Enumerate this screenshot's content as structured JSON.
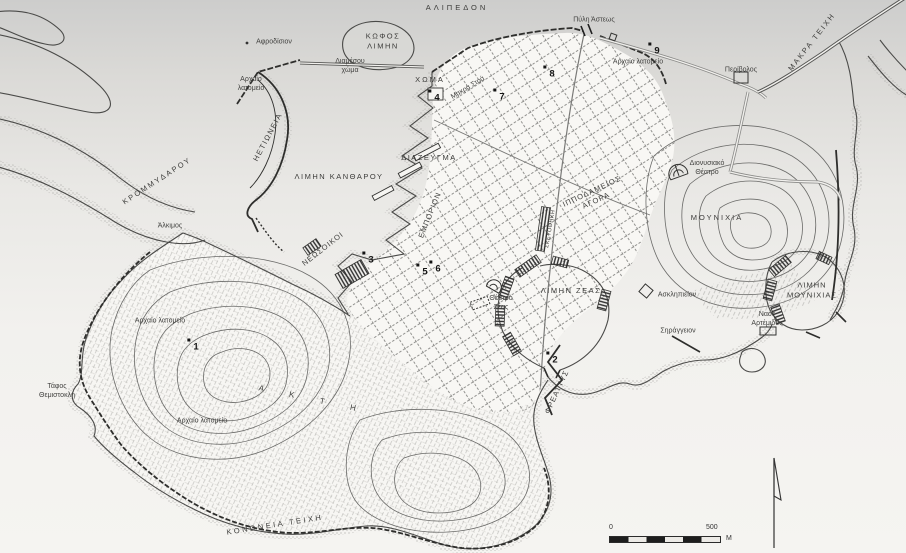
{
  "map": {
    "title": "Χάρτης αρχαίου Πειραιά",
    "scale_bar": {
      "zero": "0",
      "five_hundred": "500",
      "unit": "M"
    },
    "colors": {
      "ink": "#3d3d3b",
      "paper": "#f3f2ef",
      "paper_top": "#cdcdcc",
      "shade": "#b9b8b5",
      "wall": "#2e2e2c"
    },
    "labels": [
      {
        "id": "alipedon",
        "text": "ΑΛΙΠΕΔΟΝ",
        "x": 457,
        "y": 8,
        "cls": "region",
        "ls": 3
      },
      {
        "id": "kofos-limen",
        "lines": [
          "ΚΩΦΟΣ",
          "ΛΙΜΗΝ"
        ],
        "x": 383,
        "y": 41,
        "cls": "region",
        "ls": 1.5
      },
      {
        "id": "pyli-asteos",
        "text": "Πύλη Άστεως",
        "x": 594,
        "y": 20,
        "cls": "place"
      },
      {
        "id": "afrodision",
        "text": "Αφροδίσιον",
        "x": 274,
        "y": 42,
        "cls": "place"
      },
      {
        "id": "archaio-latomeio-west",
        "lines": [
          "Αρχαίο",
          "λατομείο"
        ],
        "x": 251,
        "y": 84,
        "cls": "place"
      },
      {
        "id": "diamesou-choma",
        "lines": [
          "Διαμέσου",
          "χώμα"
        ],
        "x": 350,
        "y": 66,
        "cls": "place"
      },
      {
        "id": "choma",
        "text": "ΧΩΜΑ",
        "x": 430,
        "y": 80,
        "cls": "region",
        "ls": 2
      },
      {
        "id": "makra-stoa",
        "text": "Μακρά Στοά",
        "x": 468,
        "y": 88,
        "rot": -31,
        "cls": "place"
      },
      {
        "id": "archaio-latomeio-ne",
        "text": "Αρχαίο λατομείο",
        "x": 638,
        "y": 62,
        "cls": "place"
      },
      {
        "id": "perivolos",
        "text": "Περίβολος",
        "x": 741,
        "y": 70,
        "cls": "place"
      },
      {
        "id": "makra-teichi",
        "text": "ΜΑΚΡΑ ΤΕΙΧΗ",
        "x": 812,
        "y": 42,
        "rot": -52,
        "cls": "region",
        "ls": 2
      },
      {
        "id": "hetioneia",
        "text": "ΗΕΤΙΩΝΕΙΑ",
        "x": 268,
        "y": 137,
        "rot": -62,
        "cls": "region",
        "ls": 1.5
      },
      {
        "id": "krommydarou",
        "text": "ΚΡΟΜΜΥΔΑΡΟΥ",
        "x": 157,
        "y": 181,
        "rot": -33,
        "cls": "region",
        "ls": 2
      },
      {
        "id": "limen-kantharou",
        "text": "ΛΙΜΗΝ ΚΑΝΘΑΡΟΥ",
        "x": 339,
        "y": 177,
        "cls": "region",
        "ls": 1.5
      },
      {
        "id": "diazeugma",
        "text": "ΔΙΑΖΕΥΓΜΑ",
        "x": 429,
        "y": 158,
        "cls": "region",
        "ls": 1.5
      },
      {
        "id": "emporion",
        "text": "ΕΜΠΟΡΙΟΝ",
        "x": 430,
        "y": 215,
        "rot": -68,
        "cls": "region",
        "ls": 1
      },
      {
        "id": "dionysiako-theatro",
        "lines": [
          "Διονυσιακό",
          "Θέατρο"
        ],
        "x": 707,
        "y": 168,
        "cls": "place"
      },
      {
        "id": "hippodameios-agora",
        "lines": [
          "ΙΠΠΟΔΑΜΕΙΟΣ",
          "ΑΓΟΡΑ"
        ],
        "x": 594,
        "y": 196,
        "rot": -25,
        "cls": "region",
        "ls": 1
      },
      {
        "id": "mounichia",
        "text": "ΜΟΥΝΙΧΙΑ",
        "x": 717,
        "y": 218,
        "cls": "region",
        "ls": 2
      },
      {
        "id": "alkimos",
        "text": "Άλκιμος",
        "x": 170,
        "y": 226,
        "cls": "place"
      },
      {
        "id": "neosoikoi",
        "text": "ΝΕΩΣΟΙΚΟΙ",
        "x": 323,
        "y": 249,
        "rot": -38,
        "cls": "region",
        "ls": 1
      },
      {
        "id": "skeyothiki",
        "text": "ΣΚΕΥΟΘΗΚΗ",
        "x": 551,
        "y": 229,
        "rot": -80,
        "cls": "region",
        "fs": 5.5,
        "ls": 0.5
      },
      {
        "id": "limen-zeas",
        "text": "ΛΙΜΗΝ ΖΕΑΣ",
        "x": 571,
        "y": 291,
        "cls": "region",
        "ls": 1.5
      },
      {
        "id": "theatro-zeas",
        "lines": [
          "Θέατρο",
          "Ζέας"
        ],
        "x": 501,
        "y": 303,
        "cls": "place"
      },
      {
        "id": "asklipieion",
        "text": "Ασκληπιείον",
        "x": 677,
        "y": 295,
        "cls": "place"
      },
      {
        "id": "limen-mounichias",
        "lines": [
          "ΛΙΜΗΝ",
          "ΜΟΥΝΙΧΙΑΣ"
        ],
        "x": 812,
        "y": 290,
        "cls": "region",
        "ls": 1
      },
      {
        "id": "naos-artemidos",
        "lines": [
          "Ναός",
          "Αρτέμιδος"
        ],
        "x": 767,
        "y": 319,
        "cls": "place"
      },
      {
        "id": "syrangeion",
        "text": "Σηράγγειον",
        "x": 678,
        "y": 331,
        "cls": "place"
      },
      {
        "id": "archaio-latomeio-akti-n",
        "text": "Αρχαίο λατομείο",
        "x": 160,
        "y": 321,
        "cls": "place"
      },
      {
        "id": "tafos-themistokli",
        "lines": [
          "Τάφος",
          "Θεμιστοκλή"
        ],
        "x": 57,
        "y": 391,
        "cls": "place"
      },
      {
        "id": "akti",
        "text": "Α Κ Τ Η",
        "x": 313,
        "y": 400,
        "rot": 12,
        "cls": "region",
        "ls": 12,
        "fs": 8
      },
      {
        "id": "archaio-latomeio-akti-s",
        "text": "Αρχαίο λατομείο",
        "x": 202,
        "y": 421,
        "cls": "place"
      },
      {
        "id": "freattys",
        "text": "ΦΡΕΑΤΤΥΣ",
        "x": 557,
        "y": 392,
        "rot": -65,
        "cls": "region",
        "ls": 1
      },
      {
        "id": "kononeia-teichi",
        "text": "ΚΟΝΩΝΕΙΑ ΤΕΙΧΗ",
        "x": 275,
        "y": 525,
        "rot": -9,
        "cls": "region",
        "ls": 2.5
      }
    ],
    "markers": [
      {
        "n": "1",
        "x": 196,
        "y": 347
      },
      {
        "n": "2",
        "x": 555,
        "y": 360
      },
      {
        "n": "3",
        "x": 371,
        "y": 260
      },
      {
        "n": "4",
        "x": 437,
        "y": 98
      },
      {
        "n": "5",
        "x": 425,
        "y": 272
      },
      {
        "n": "6",
        "x": 438,
        "y": 269
      },
      {
        "n": "7",
        "x": 502,
        "y": 97
      },
      {
        "n": "8",
        "x": 552,
        "y": 74
      },
      {
        "n": "9",
        "x": 657,
        "y": 51
      }
    ]
  }
}
